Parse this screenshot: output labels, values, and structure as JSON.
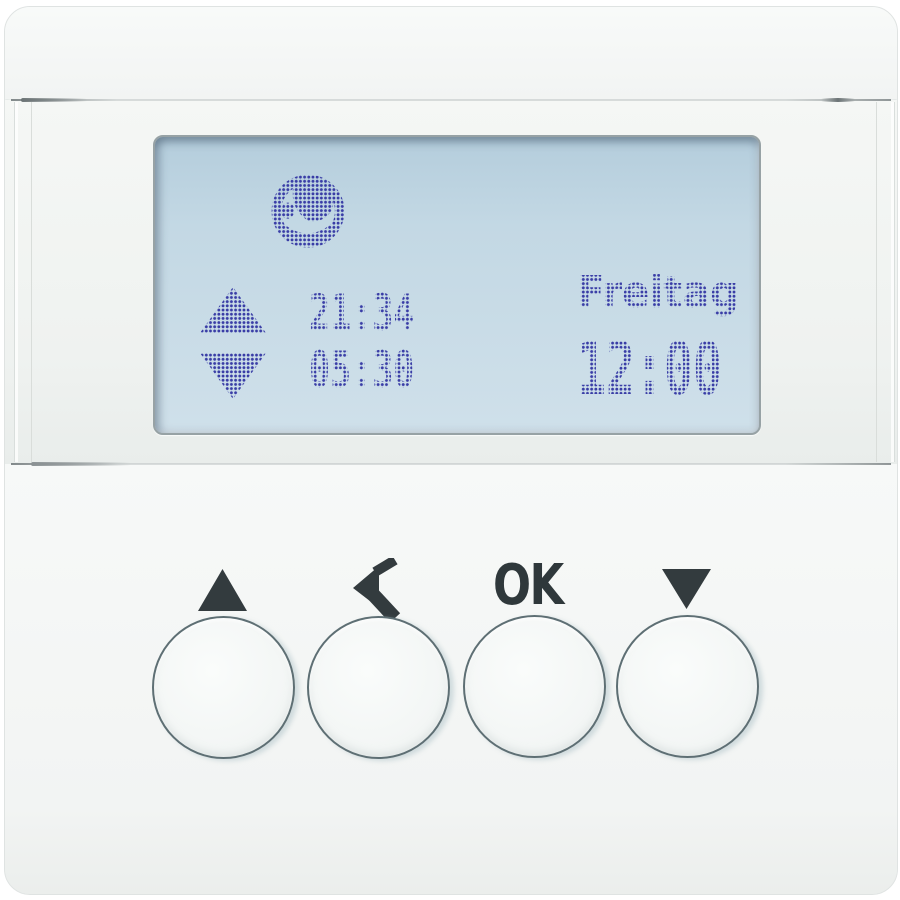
{
  "device": {
    "name": "blind-control-timer",
    "display": {
      "weekday": "Freitag",
      "clock": "12:00",
      "raise_time": "21:34",
      "lower_time": "05:30",
      "icons": [
        "globe-icon",
        "blind-up-icon",
        "blind-down-icon"
      ]
    },
    "buttons": [
      {
        "id": "up",
        "icon": "triangle-up-icon",
        "label": ""
      },
      {
        "id": "back",
        "icon": "arrow-back-icon",
        "label": ""
      },
      {
        "id": "ok",
        "icon": "",
        "label": "OK"
      },
      {
        "id": "down",
        "icon": "triangle-down-icon",
        "label": ""
      }
    ],
    "colors": {
      "lcd_background": "#c3d8e4",
      "lcd_pixels": "#393da6",
      "printed_labels": "#333b3e",
      "button_ring": "#5e6f74",
      "plate": "#f3f5f4"
    }
  }
}
